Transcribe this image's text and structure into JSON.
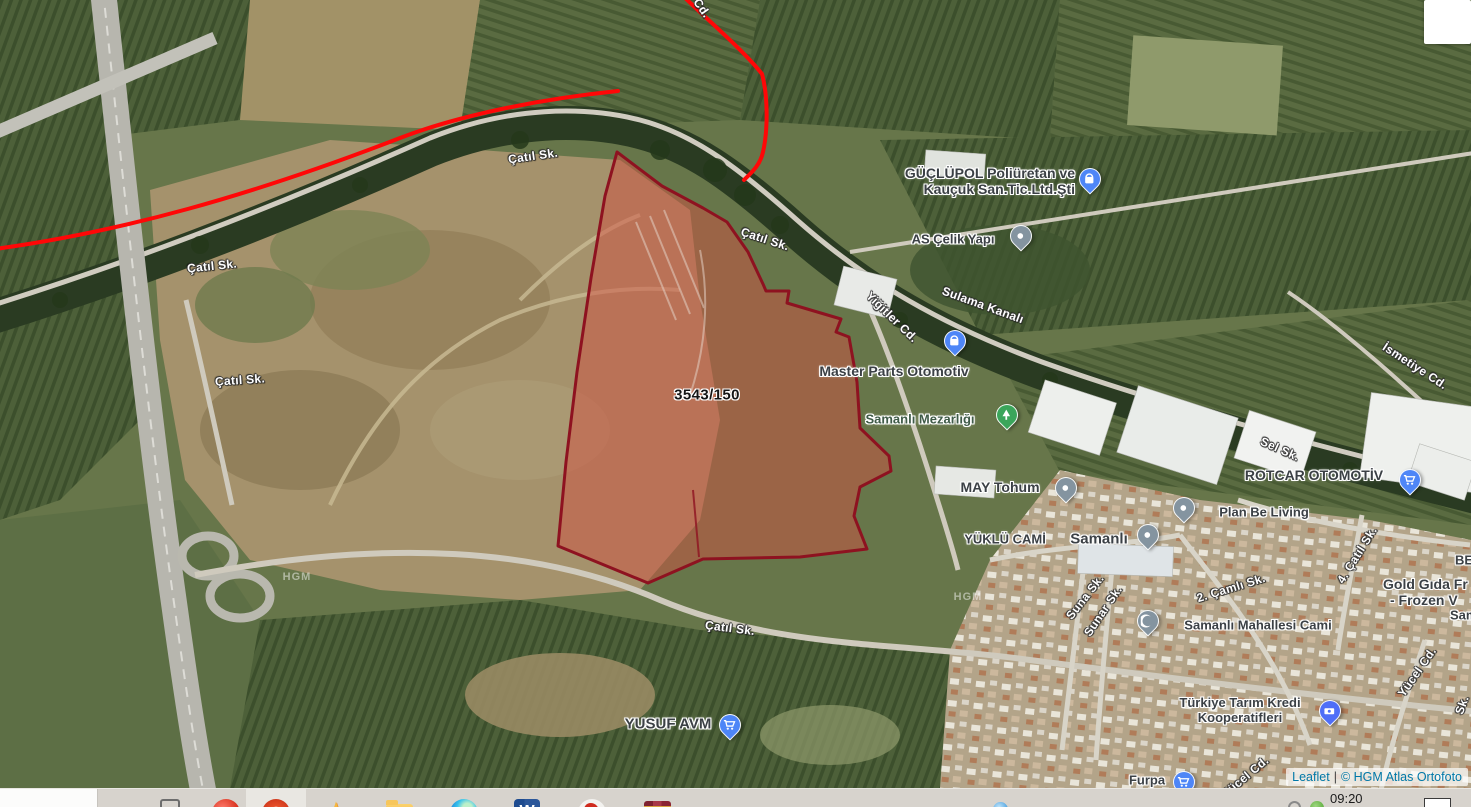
{
  "map": {
    "attribution": {
      "library": "Leaflet",
      "separator": "|",
      "provider": "© HGM Atlas Ortofoto"
    },
    "parcel": {
      "label": "3543/150",
      "fill_color": "#cf5242",
      "outline_color": "#8e1220"
    },
    "route": {
      "color": "#ff0000"
    },
    "street_labels": [
      {
        "text": "Çatıl Sk."
      },
      {
        "text": "Çatıl Sk."
      },
      {
        "text": "Çatıl Sk."
      },
      {
        "text": "Çatıl Sk."
      },
      {
        "text": "Çatıl Sk."
      },
      {
        "text": "Sulama Kanalı"
      },
      {
        "text": "Yiğitler Cd."
      },
      {
        "text": "Sel Sk."
      },
      {
        "text": "İsmetiye Cd."
      },
      {
        "text": "Suna Sk."
      },
      {
        "text": "Sunar Sk."
      },
      {
        "text": "2. Çamlı Sk."
      },
      {
        "text": "4. Çatıl Sk."
      },
      {
        "text": "Yücel Cd."
      },
      {
        "text": "Yücel Cd."
      },
      {
        "text": "Sk."
      },
      {
        "text": "Cd."
      }
    ],
    "poi_labels": [
      {
        "line1": "GÜÇLÜPOL Poliüretan ve",
        "line2": "Kauçuk San.Tic.Ltd.Şti"
      },
      {
        "line1": "AS Çelik Yapı"
      },
      {
        "line1": "Master Parts Otomotiv"
      },
      {
        "line1": "Samanlı Mezarlığı"
      },
      {
        "line1": "MAY Tohum"
      },
      {
        "line1": "ROTCAR OTOMOTİV"
      },
      {
        "line1": "Plan Be Living"
      },
      {
        "line1": "YÜKLÜ CAMİ"
      },
      {
        "line1": "Samanlı"
      },
      {
        "line1": "Samanlı Mahallesi Cami"
      },
      {
        "line1": "Türkiye Tarım Kredi",
        "line2": "Kooperatifleri"
      },
      {
        "line1": "YUSUF AVM"
      },
      {
        "line1": "Furpa"
      },
      {
        "line1": "Gold Gıda Fr",
        "line2": "- Frozen V"
      },
      {
        "line1": "BE"
      },
      {
        "line1": "Sam"
      }
    ],
    "pins": [
      {
        "icon": "shopping-bag",
        "color": "#4e86f7"
      },
      {
        "icon": "dot",
        "color": "#8494a0"
      },
      {
        "icon": "shopping-bag",
        "color": "#4e86f7"
      },
      {
        "icon": "tree",
        "color": "#3ba55b"
      },
      {
        "icon": "dot",
        "color": "#8494a0"
      },
      {
        "icon": "shopping-cart",
        "color": "#4e86f7"
      },
      {
        "icon": "dot",
        "color": "#8494a0"
      },
      {
        "icon": "dot",
        "color": "#8494a0"
      },
      {
        "icon": "crescent",
        "color": "#8494a0"
      },
      {
        "icon": "banknote",
        "color": "#4f6ef7"
      },
      {
        "icon": "shopping-cart",
        "color": "#4e86f7"
      },
      {
        "icon": "shopping-cart",
        "color": "#4e86f7"
      }
    ],
    "watermarks": [
      {
        "text": "HGM"
      },
      {
        "text": "HGM"
      }
    ]
  },
  "taskbar": {
    "clock": "09:20",
    "icons": [
      {
        "name": "task-view"
      },
      {
        "name": "browser-red"
      },
      {
        "name": "browser-orange-active"
      },
      {
        "name": "photos-star"
      },
      {
        "name": "file-explorer"
      },
      {
        "name": "edge-browser"
      },
      {
        "name": "word"
      },
      {
        "name": "paint"
      },
      {
        "name": "archive-books"
      },
      {
        "name": "map-app"
      },
      {
        "name": "tray-status-ring"
      },
      {
        "name": "tray-green"
      },
      {
        "name": "show-hidden-box"
      }
    ]
  }
}
